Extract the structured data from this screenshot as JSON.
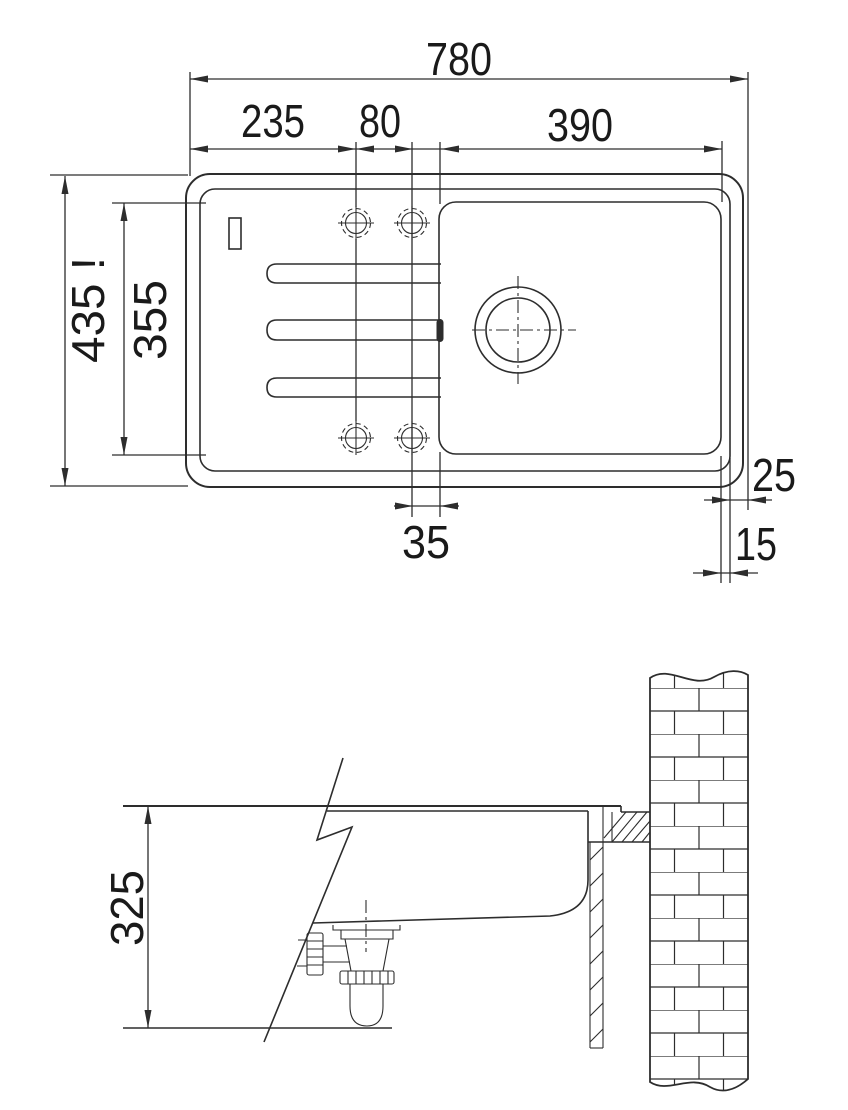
{
  "drawing": {
    "type": "sink-installation-technical-drawing",
    "views": {
      "top_view": "plan view of inset sink with drainer, tap holes and bowl",
      "side_view": "section view of bowl, waste trap, worktop and brick wall"
    },
    "colors": {
      "line": "#2d2d2d",
      "text": "#1a1a1a",
      "dim_red": "#d92b1c",
      "background": "#ffffff"
    },
    "dims": {
      "overall_width": "780",
      "drainer_width": "235",
      "tap_hole_spacing": "80",
      "bowl_width": "390",
      "overall_depth": "435 !",
      "inner_depth": "355",
      "tap_hole_to_bowl": "35",
      "rim_to_edge": "25",
      "bowl_to_rim": "15",
      "installation_depth": "325"
    }
  }
}
